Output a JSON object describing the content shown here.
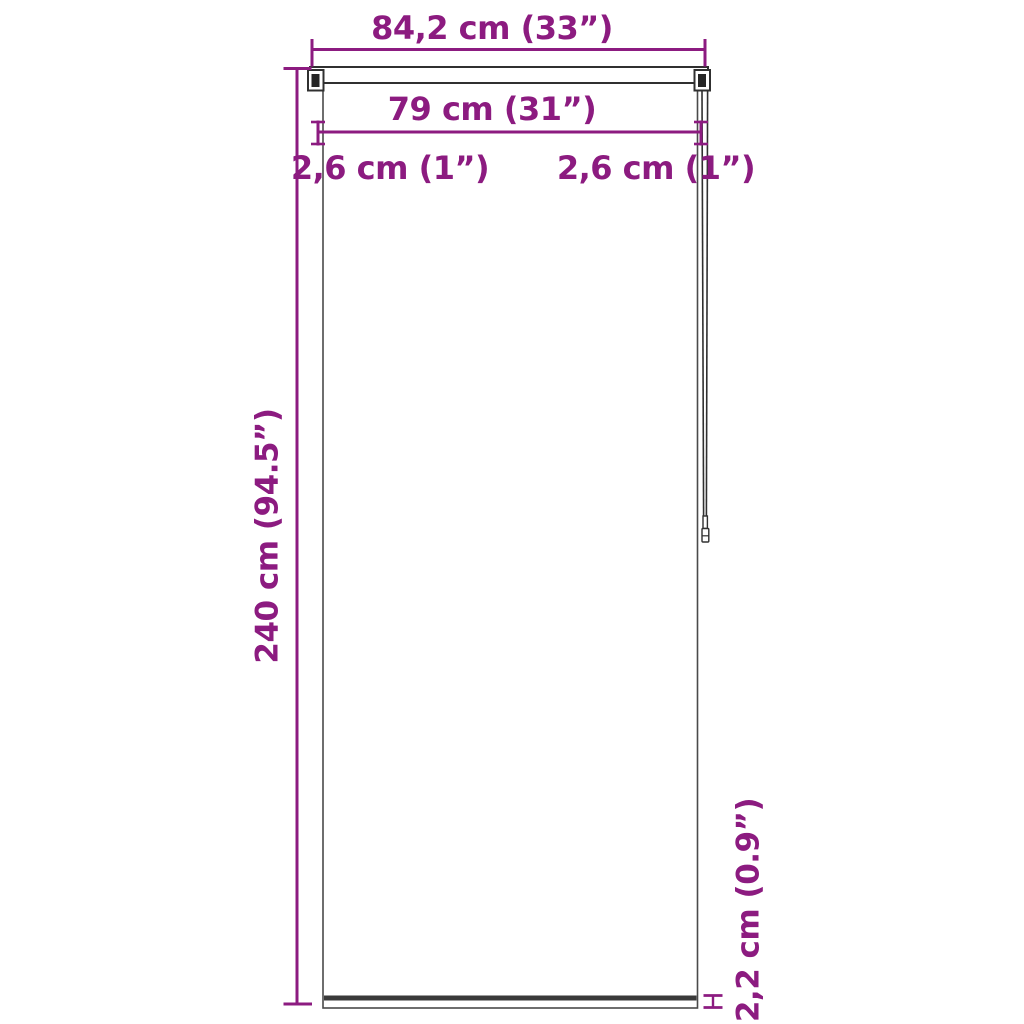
{
  "figure": {
    "type": "product-dimension-diagram",
    "subject": "roller-blind-front-view"
  },
  "colors": {
    "dimension_accent": "#8C1B80",
    "outline_dark": "#303030",
    "panel_border": "#4A4A4A",
    "bottom_bar_fill": "#3A3A3A",
    "background": "#FFFFFF"
  },
  "labels": {
    "total_width": "84,2 cm (33”)",
    "fabric_width": "79 cm (31”)",
    "left_offset": "2,6 cm (1”)",
    "right_offset": "2,6 cm (1”)",
    "total_height": "240 cm (94.5”)",
    "bottom_bar_height": "2,2 cm (0.9”)"
  }
}
